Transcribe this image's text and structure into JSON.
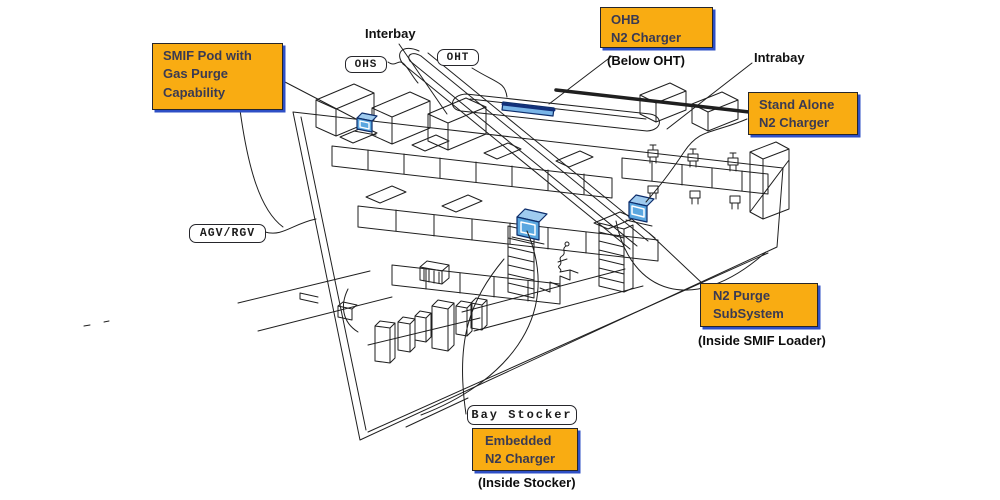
{
  "callouts": {
    "smif_pod": {
      "line1": "SMIF Pod with",
      "line2": "Gas Purge",
      "line3": "Capability"
    },
    "ohb": {
      "line1": "OHB",
      "line2": "N2 Charger",
      "note": "(Below OHT)"
    },
    "stand_alone": {
      "line1": "Stand Alone",
      "line2": "N2 Charger"
    },
    "n2_purge": {
      "line1": "N2 Purge",
      "line2": "SubSystem",
      "note": "(Inside SMIF  Loader)"
    },
    "embedded": {
      "line1": "Embedded",
      "line2": "N2 Charger",
      "note": "(Inside Stocker)"
    }
  },
  "tags": {
    "ohs": "OHS",
    "oht": "OHT",
    "agv_rgv": "AGV/RGV",
    "bay_stocker": "Bay Stocker"
  },
  "labels": {
    "interbay": "Interbay",
    "intrabay": "Intrabay"
  },
  "colors": {
    "callout_fill": "#F9AC12",
    "callout_shadow": "#2E4FC5",
    "line": "#1F1F1F",
    "charger_blue": "#5AA7E0",
    "charger_blue_light": "#9FCBEF",
    "charger_blue_dark": "#0D2D6B"
  }
}
